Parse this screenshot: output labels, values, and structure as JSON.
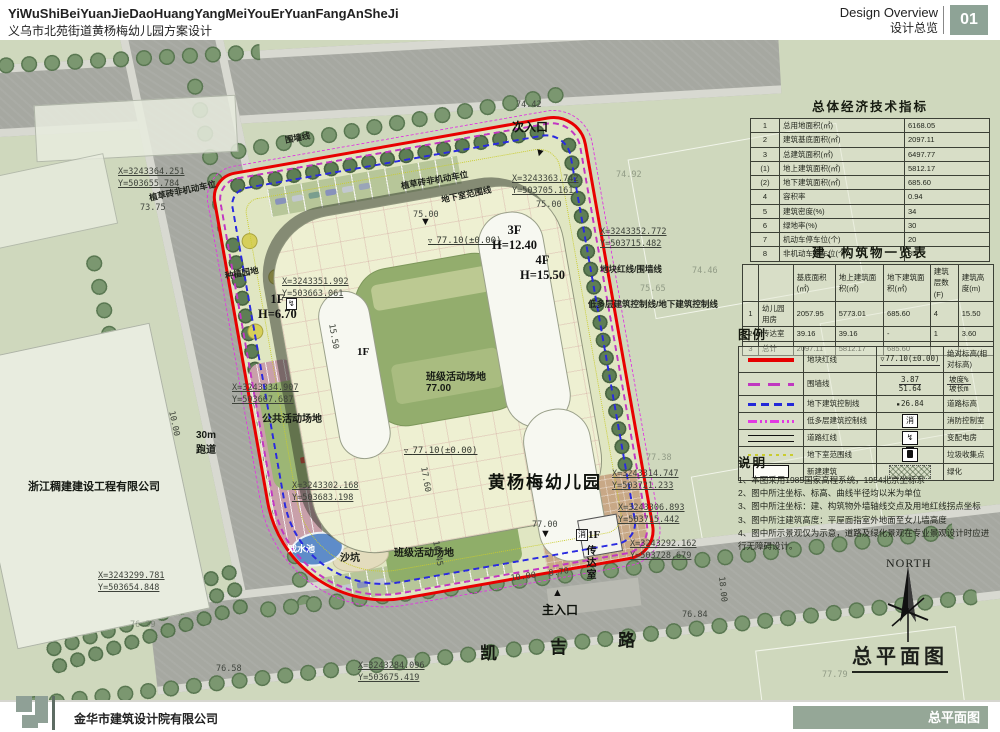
{
  "header": {
    "title_en": "YiWuShiBeiYuanJieDaoHuangYangMeiYouErYuanFangAnSheJi",
    "title_zh": "义乌市北苑街道黄杨梅幼儿园方案设计",
    "overview_en": "Design Overview",
    "overview_zh": "设计总览",
    "page_number": "01",
    "badge_color": "#8ea396"
  },
  "footer": {
    "company": "金华市建筑设计院有限公司",
    "sheet_label": "总平面图",
    "bar_color": "#95a797"
  },
  "panels": {
    "economic": {
      "title": "总体经济技术指标",
      "rows": [
        [
          "1",
          "总用地面积(㎡)",
          "6168.05"
        ],
        [
          "2",
          "建筑基底面积(㎡)",
          "2097.11"
        ],
        [
          "3",
          "总建筑面积(㎡)",
          "6497.77"
        ],
        [
          "(1)",
          "地上建筑面积(㎡)",
          "5812.17"
        ],
        [
          "(2)",
          "地下建筑面积(㎡)",
          "685.60"
        ],
        [
          "4",
          "容积率",
          "0.94"
        ],
        [
          "5",
          "建筑密度(%)",
          "34"
        ],
        [
          "6",
          "绿地率(%)",
          "30"
        ],
        [
          "7",
          "机动车停车位(个)",
          "20"
        ],
        [
          "8",
          "非机动车停车位(个)",
          "35"
        ]
      ]
    },
    "buildings": {
      "title": "建、构筑物一览表",
      "headers": [
        "",
        "",
        "基底面积(㎡)",
        "地上建筑面积(㎡)",
        "地下建筑面积(㎡)",
        "建筑层数(F)",
        "建筑高度(m)"
      ],
      "rows": [
        [
          "1",
          "幼儿园用房",
          "2057.95",
          "5773.01",
          "685.60",
          "4",
          "15.50"
        ],
        [
          "2",
          "传达室",
          "39.16",
          "39.16",
          "-",
          "1",
          "3.60"
        ],
        [
          "3",
          "总计",
          "2097.11",
          "5812.17",
          "685.60",
          "",
          ""
        ]
      ]
    },
    "legend": {
      "title": "图例",
      "rows": [
        {
          "s1": "red-line",
          "l1": "地块红线",
          "s2": "elev-mark",
          "v": "77.10(±0.00)",
          "l2": "绝对标高(相对标高)"
        },
        {
          "s1": "fence-line",
          "l1": "围墙线",
          "s2": "slope-mark",
          "v": "3.87\n51.64",
          "l2": "坡度%\n坡长m"
        },
        {
          "s1": "blue-dash",
          "l1": "地下建筑控制线",
          "s2": "road-elev",
          "v": "26.84",
          "l2": "道路标高"
        },
        {
          "s1": "multi-dash",
          "l1": "低多层建筑控制线",
          "s2": "fire-box",
          "v": "消",
          "l2": "消防控制室"
        },
        {
          "s1": "road-line",
          "l1": "道路红线",
          "s2": "power-box",
          "v": "↯",
          "l2": "变配电房"
        },
        {
          "s1": "yellow-dot",
          "l1": "地下室范围线",
          "s2": "trash-box",
          "v": "",
          "l2": "垃圾收集点"
        },
        {
          "s1": "new-building",
          "l1": "新建建筑",
          "s2": "green-hatch",
          "v": "",
          "l2": "绿化"
        }
      ]
    },
    "notes": {
      "title": "说明",
      "items": [
        "1、本图采用1985国家高程系统，1954北京坐标系",
        "2、图中所注坐标、标高、曲线半径均以米为单位",
        "3、图中所注坐标：建、构筑物外墙轴线交点及用地红线拐点坐标",
        "3、图中所注建筑高度：平屋面指室外地面至女儿墙高度",
        "4、图中所示景观仅为示意，道路及绿化景观在专业景观设计时应进行无障碍设计。"
      ]
    }
  },
  "plan": {
    "drawing_title": "总平面图",
    "north_label": "NORTH",
    "labels": [
      {
        "t": "X=3243364.251\nY=503655.784",
        "x": 118,
        "y": 126,
        "k": "coord",
        "n": "coord-nw"
      },
      {
        "t": "73.75",
        "x": 140,
        "y": 163,
        "k": "elev"
      },
      {
        "t": "围墙线",
        "x": 284,
        "y": 94,
        "r": -10,
        "k": "lbl-s",
        "n": "fence-label"
      },
      {
        "t": "74.42",
        "x": 516,
        "y": 60,
        "k": "elev"
      },
      {
        "t": "次入口",
        "x": 512,
        "y": 78,
        "k": "ent",
        "n": "secondary-entrance-label"
      },
      {
        "t": "▼",
        "x": 536,
        "y": 106,
        "r": 15,
        "k": "mark"
      },
      {
        "t": "X=3243363.742\nY=503705.161",
        "x": 512,
        "y": 133,
        "k": "coord",
        "n": "coord-ne"
      },
      {
        "t": "75.00",
        "x": 536,
        "y": 160,
        "k": "elev"
      },
      {
        "t": "75.00",
        "x": 413,
        "y": 170,
        "k": "elev"
      },
      {
        "t": "植草砖非机动车位",
        "x": 148,
        "y": 152,
        "r": -12,
        "k": "lbl-s",
        "n": "bike-parking-label"
      },
      {
        "t": "植草砖非机动车位",
        "x": 400,
        "y": 140,
        "r": -10,
        "k": "lbl-s",
        "n": "bike-parking-label"
      },
      {
        "t": "地下室范围线",
        "x": 440,
        "y": 154,
        "r": -12,
        "k": "lbl-s",
        "n": "basement-extent-label"
      },
      {
        "t": "▼",
        "x": 420,
        "y": 176,
        "k": "mark"
      },
      {
        "t": "77.10(±0.00)",
        "x": 428,
        "y": 196,
        "k": "elevm"
      },
      {
        "t": "3F\nH=12.40",
        "x": 492,
        "y": 183,
        "k": "bld",
        "n": "wing-3f-label"
      },
      {
        "t": "4F\nH=15.50",
        "x": 520,
        "y": 213,
        "k": "bld",
        "n": "wing-4f-label"
      },
      {
        "t": "种植园地",
        "x": 224,
        "y": 230,
        "r": -10,
        "k": "lbl-s",
        "n": "planting-garden-label"
      },
      {
        "t": "X=3243351.992\nY=503663.061",
        "x": 282,
        "y": 236,
        "k": "coord"
      },
      {
        "t": "↯",
        "x": 286,
        "y": 258,
        "k": "box",
        "n": "power-room-icon"
      },
      {
        "t": "1F\nH=6.70",
        "x": 258,
        "y": 252,
        "k": "bld",
        "n": "wing-1f-label"
      },
      {
        "t": "X=3243352.772\nY=503715.482",
        "x": 600,
        "y": 186,
        "k": "coord"
      },
      {
        "t": "地块红线/围墙线",
        "x": 600,
        "y": 223,
        "k": "lbl-s",
        "n": "redline-fence-label"
      },
      {
        "t": "74.46",
        "x": 692,
        "y": 226,
        "k": "elev-f"
      },
      {
        "t": "74.92",
        "x": 616,
        "y": 130,
        "k": "elev-f"
      },
      {
        "t": "75.65",
        "x": 640,
        "y": 244,
        "k": "elev-f"
      },
      {
        "t": "低多层建筑控制线/地下建筑控制线",
        "x": 588,
        "y": 258,
        "k": "lbl-s",
        "n": "control-line-label"
      },
      {
        "t": "15.50",
        "x": 336,
        "y": 283,
        "r": 80,
        "k": "dim"
      },
      {
        "t": "1F",
        "x": 357,
        "y": 306,
        "k": "bld2"
      },
      {
        "t": "班级活动场地\n77.00",
        "x": 426,
        "y": 328,
        "k": "lbl",
        "n": "class-playground-label"
      },
      {
        "t": "X=3243334.907\nY=503667.687",
        "x": 232,
        "y": 342,
        "k": "coord"
      },
      {
        "t": "公共活动场地",
        "x": 262,
        "y": 370,
        "k": "lbl",
        "n": "public-playground-label"
      },
      {
        "t": "10.00",
        "x": 176,
        "y": 370,
        "r": 78,
        "k": "dim"
      },
      {
        "t": "30m\n跑道",
        "x": 196,
        "y": 390,
        "k": "lbl",
        "n": "running-track-label"
      },
      {
        "t": "77.10(±0.00)",
        "x": 404,
        "y": 406,
        "k": "elevm"
      },
      {
        "t": "17.60",
        "x": 428,
        "y": 426,
        "r": 80,
        "k": "dim"
      },
      {
        "t": "黄杨梅幼儿园",
        "x": 488,
        "y": 428,
        "k": "big",
        "n": "kindergarten-name-label"
      },
      {
        "t": "X=3243302.168\nY=503683.198",
        "x": 292,
        "y": 440,
        "k": "coord"
      },
      {
        "t": "77.38",
        "x": 646,
        "y": 413,
        "k": "elev-f"
      },
      {
        "t": "X=3243314.747\nY=503721.233",
        "x": 612,
        "y": 428,
        "k": "coord"
      },
      {
        "t": "X=3243306.893\nY=503715.442",
        "x": 618,
        "y": 462,
        "k": "coord"
      },
      {
        "t": "X=3243292.162\nY=503728.679",
        "x": 630,
        "y": 498,
        "k": "coord"
      },
      {
        "t": "浙江稠建建设工程有限公司",
        "x": 28,
        "y": 438,
        "k": "lbl-b",
        "n": "neighbor-company-label"
      },
      {
        "t": "76.39",
        "x": 130,
        "y": 580,
        "k": "elev-f"
      },
      {
        "t": "戏水池",
        "x": 288,
        "y": 502,
        "k": "lblw",
        "n": "water-pool-label"
      },
      {
        "t": "沙坑",
        "x": 340,
        "y": 509,
        "k": "lbl",
        "n": "sand-pit-label"
      },
      {
        "t": "班级活动场地",
        "x": 394,
        "y": 504,
        "k": "lbl",
        "n": "class-playground-label"
      },
      {
        "t": "16.45",
        "x": 440,
        "y": 500,
        "r": 80,
        "k": "dim"
      },
      {
        "t": "77.00",
        "x": 532,
        "y": 480,
        "k": "elev"
      },
      {
        "t": "▼",
        "x": 540,
        "y": 488,
        "k": "mark"
      },
      {
        "t": "消",
        "x": 576,
        "y": 489,
        "k": "box",
        "n": "fire-room-icon"
      },
      {
        "t": "1F",
        "x": 588,
        "y": 489,
        "k": "bld2"
      },
      {
        "t": "传达室",
        "x": 582,
        "y": 505,
        "k": "vert",
        "n": "gatehouse-label"
      },
      {
        "t": "10.00",
        "x": 510,
        "y": 534,
        "r": -8,
        "k": "dim"
      },
      {
        "t": "8.70",
        "x": 548,
        "y": 529,
        "r": -8,
        "k": "dim"
      },
      {
        "t": "▲",
        "x": 552,
        "y": 547,
        "k": "mark"
      },
      {
        "t": "主入口",
        "x": 542,
        "y": 561,
        "k": "ent",
        "n": "main-entrance-label"
      },
      {
        "t": "凯",
        "x": 480,
        "y": 599,
        "k": "road",
        "n": "road-name"
      },
      {
        "t": "吉",
        "x": 550,
        "y": 593,
        "k": "road",
        "n": "road-name"
      },
      {
        "t": "路",
        "x": 618,
        "y": 586,
        "k": "road",
        "n": "road-name"
      },
      {
        "t": "X=3243299.781\nY=503654.848",
        "x": 98,
        "y": 530,
        "k": "coord"
      },
      {
        "t": "76.58",
        "x": 216,
        "y": 624,
        "k": "elev"
      },
      {
        "t": "X=3243284.096\nY=503675.419",
        "x": 358,
        "y": 620,
        "k": "coord"
      },
      {
        "t": "76.84",
        "x": 682,
        "y": 570,
        "k": "elev"
      },
      {
        "t": "18.00",
        "x": 726,
        "y": 536,
        "r": 84,
        "k": "dim"
      },
      {
        "t": "77.79",
        "x": 822,
        "y": 630,
        "k": "elev-f"
      },
      {
        "t": "NORTH",
        "x": 886,
        "y": 516,
        "k": "north",
        "n": "north-label"
      },
      {
        "t": "总平面图",
        "x": 852,
        "y": 600,
        "k": "dtitle",
        "n": "drawing-title"
      }
    ]
  }
}
